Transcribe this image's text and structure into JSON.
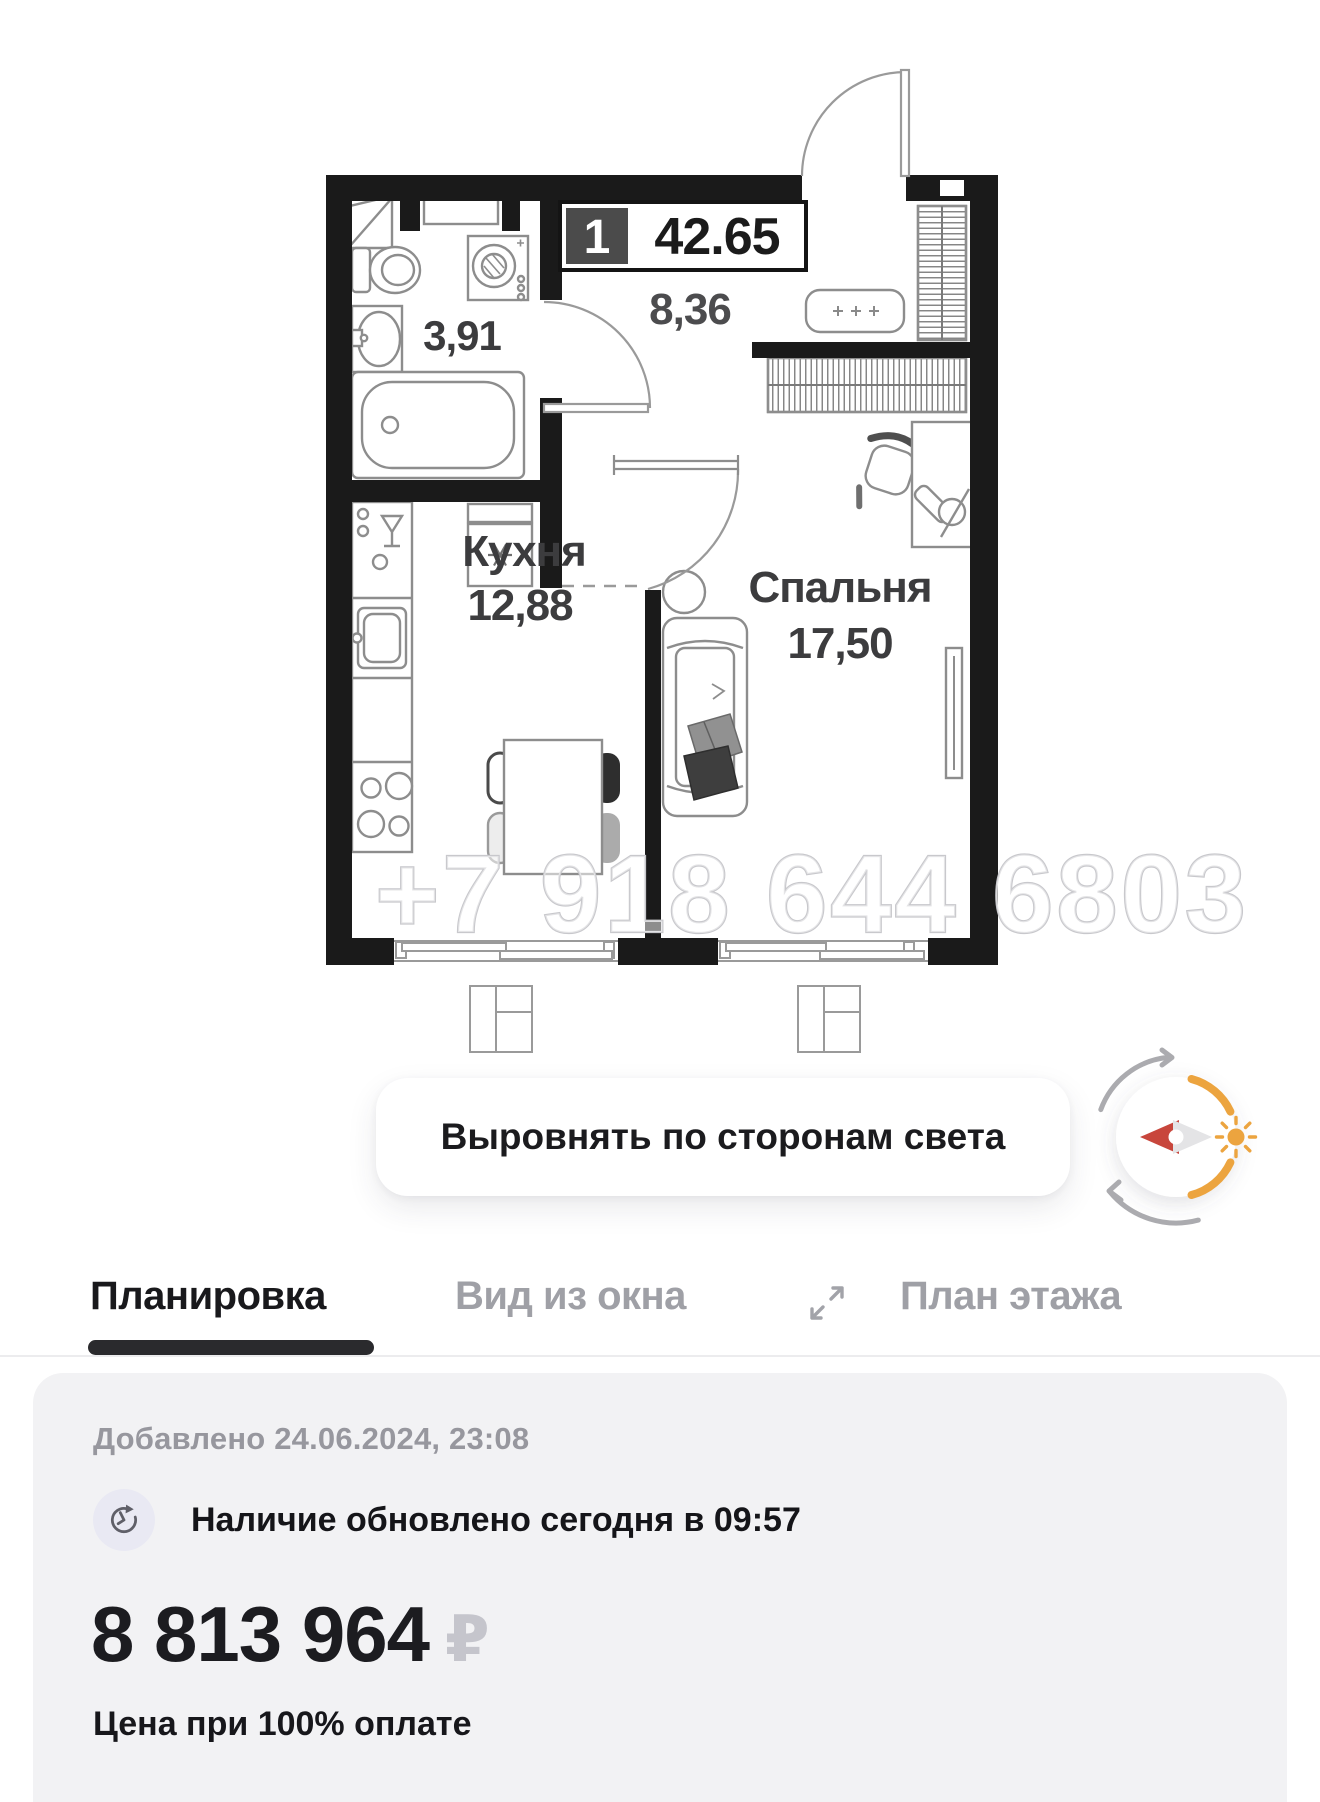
{
  "floor_plan": {
    "badge": {
      "rooms_count": "1",
      "area_m2": "42.65"
    },
    "rooms": {
      "bathroom": {
        "area": "3,91"
      },
      "hallway": {
        "area": "8,36"
      },
      "kitchen": {
        "name": "Кухня",
        "area": "12,88"
      },
      "bedroom": {
        "name": "Спальня",
        "area": "17,50"
      }
    },
    "watermark_phone": "+7 918 644 6803"
  },
  "controls": {
    "align_button_label": "Выровнять по сторонам света",
    "compass": {
      "accent_color": "#ECA43F",
      "needle_color": "#C8463C"
    }
  },
  "tabs": {
    "planirovka": "Планировка",
    "vid_iz_okna": "Вид из окна",
    "plan_etazha": "План этажа"
  },
  "info_card": {
    "added_line": "Добавлено 24.06.2024, 23:08",
    "availability_line": "Наличие обновлено сегодня в 09:57",
    "price": "8 813 964",
    "currency_symbol": "₽",
    "price_caption": "Цена при 100% оплате"
  }
}
